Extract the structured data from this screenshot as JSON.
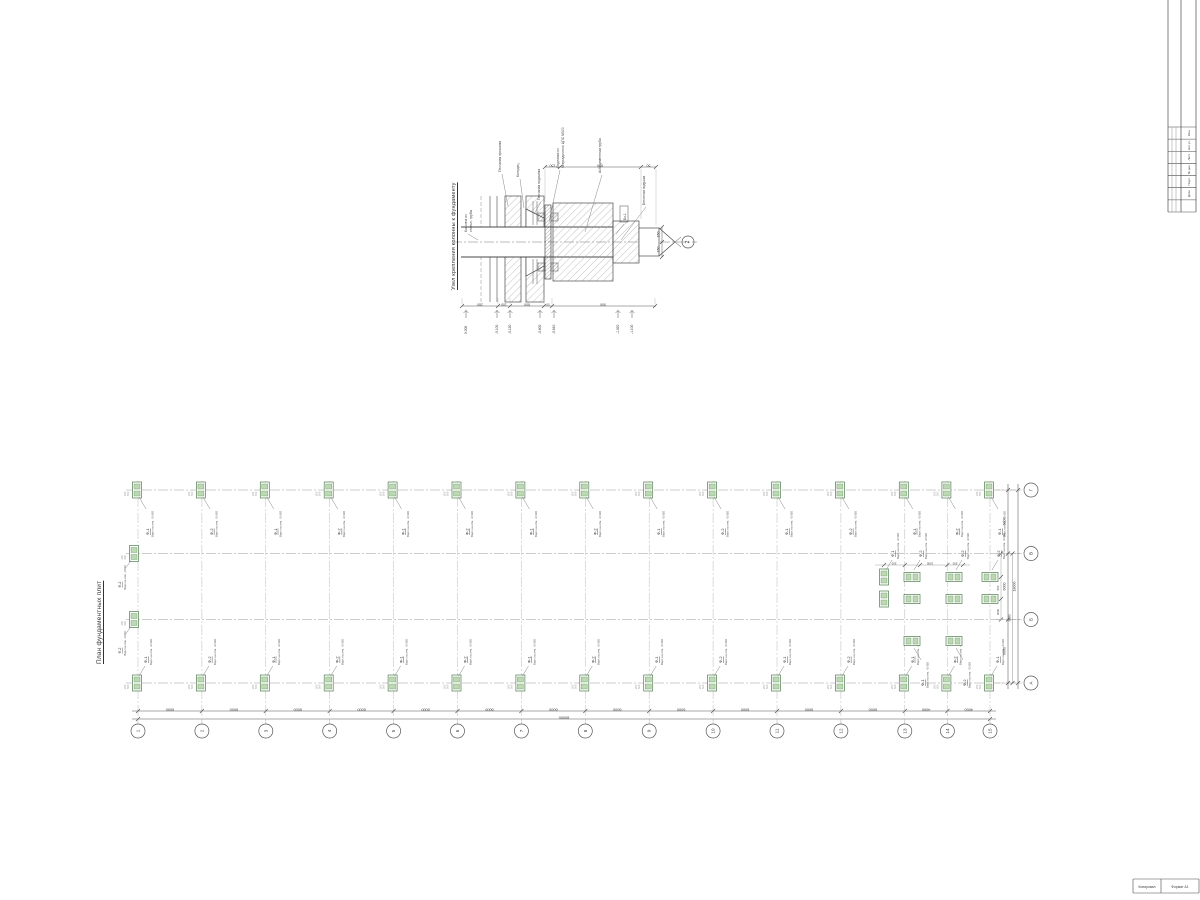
{
  "sheet": {
    "bg": "#ffffff",
    "line_color": "#4a4a4a",
    "grid_color": "#9a9a9a",
    "green": "#4e7d4e",
    "green_fill": "#bcd9b4"
  },
  "detail": {
    "title": "Узел крепления колонны к фундаменту",
    "node_ref": "2",
    "tag": "Бк-1",
    "labels": [
      {
        "name": "column-label",
        "lines": [
          "Колонна из",
          "стальн. трубы"
        ]
      },
      {
        "name": "sand-fill-label",
        "lines": [
          "Песчаная просыпка"
        ]
      },
      {
        "name": "well-label",
        "lines": [
          "Колодец"
        ]
      },
      {
        "name": "sand-bed-label",
        "lines": [
          "Песчаная подсыпка"
        ]
      },
      {
        "name": "grout-label",
        "lines": [
          "Подливка из",
          "безусадочного ЦПС М300"
        ]
      },
      {
        "name": "pipe-label",
        "lines": [
          "Асбоцементная труба"
        ]
      },
      {
        "name": "concrete-pad-label",
        "lines": [
          "Бетонная подушка"
        ]
      }
    ],
    "dims_top": [
      "150",
      "650",
      "50"
    ],
    "dims_right": [
      "150",
      "150"
    ],
    "dims_bottom": [
      "280",
      "100",
      "600",
      "50",
      "900"
    ],
    "elevations": [
      "0.000",
      "-0.100",
      "-0.150",
      "-0.600",
      "-0.640",
      "-1.020",
      "-1.100"
    ]
  },
  "plan": {
    "title": "План фундаментных плит",
    "columns": {
      "labels": [
        "1",
        "2",
        "3",
        "4",
        "5",
        "6",
        "7",
        "8",
        "9",
        "10",
        "11",
        "12",
        "13",
        "14",
        "15"
      ],
      "bays": [
        6000,
        6000,
        6000,
        6000,
        6000,
        6000,
        6000,
        6000,
        6000,
        6000,
        6000,
        6000,
        4000,
        4000
      ],
      "total_label": "80000"
    },
    "rows": {
      "labels": [
        "А",
        "Б",
        "В",
        "Г"
      ],
      "bay_labels": [
        "6000",
        "6000",
        "6000"
      ],
      "mid_label": "9000",
      "total_label": "18000"
    },
    "foundation": {
      "mark_odd": "Ф-1",
      "mark_even": "Ф-2",
      "note": "Верх на отм. -0.620",
      "micro_dims": [
        "500",
        "200"
      ]
    },
    "cluster": {
      "sub_dims_h": [
        "500",
        "1000",
        "500"
      ],
      "sub_dims_v": [
        "500",
        "2000"
      ],
      "items": [
        {
          "mark": "Ф-1"
        },
        {
          "mark": "Ф-2"
        },
        {
          "mark": "Ф-2"
        },
        {
          "mark": "Ф-2"
        },
        {
          "mark": ""
        },
        {
          "mark": ""
        },
        {
          "mark": ""
        },
        {
          "mark": ""
        },
        {
          "mark": "Ф-1"
        },
        {
          "mark": "Ф-2"
        }
      ]
    }
  },
  "titleblock": {
    "rows": [
      "Изм.",
      "Кол.уч.",
      "Лист",
      "№ док.",
      "Подп.",
      "Дата",
      ""
    ]
  },
  "footer": {
    "left": "Копировал",
    "right": "Формат А1"
  }
}
